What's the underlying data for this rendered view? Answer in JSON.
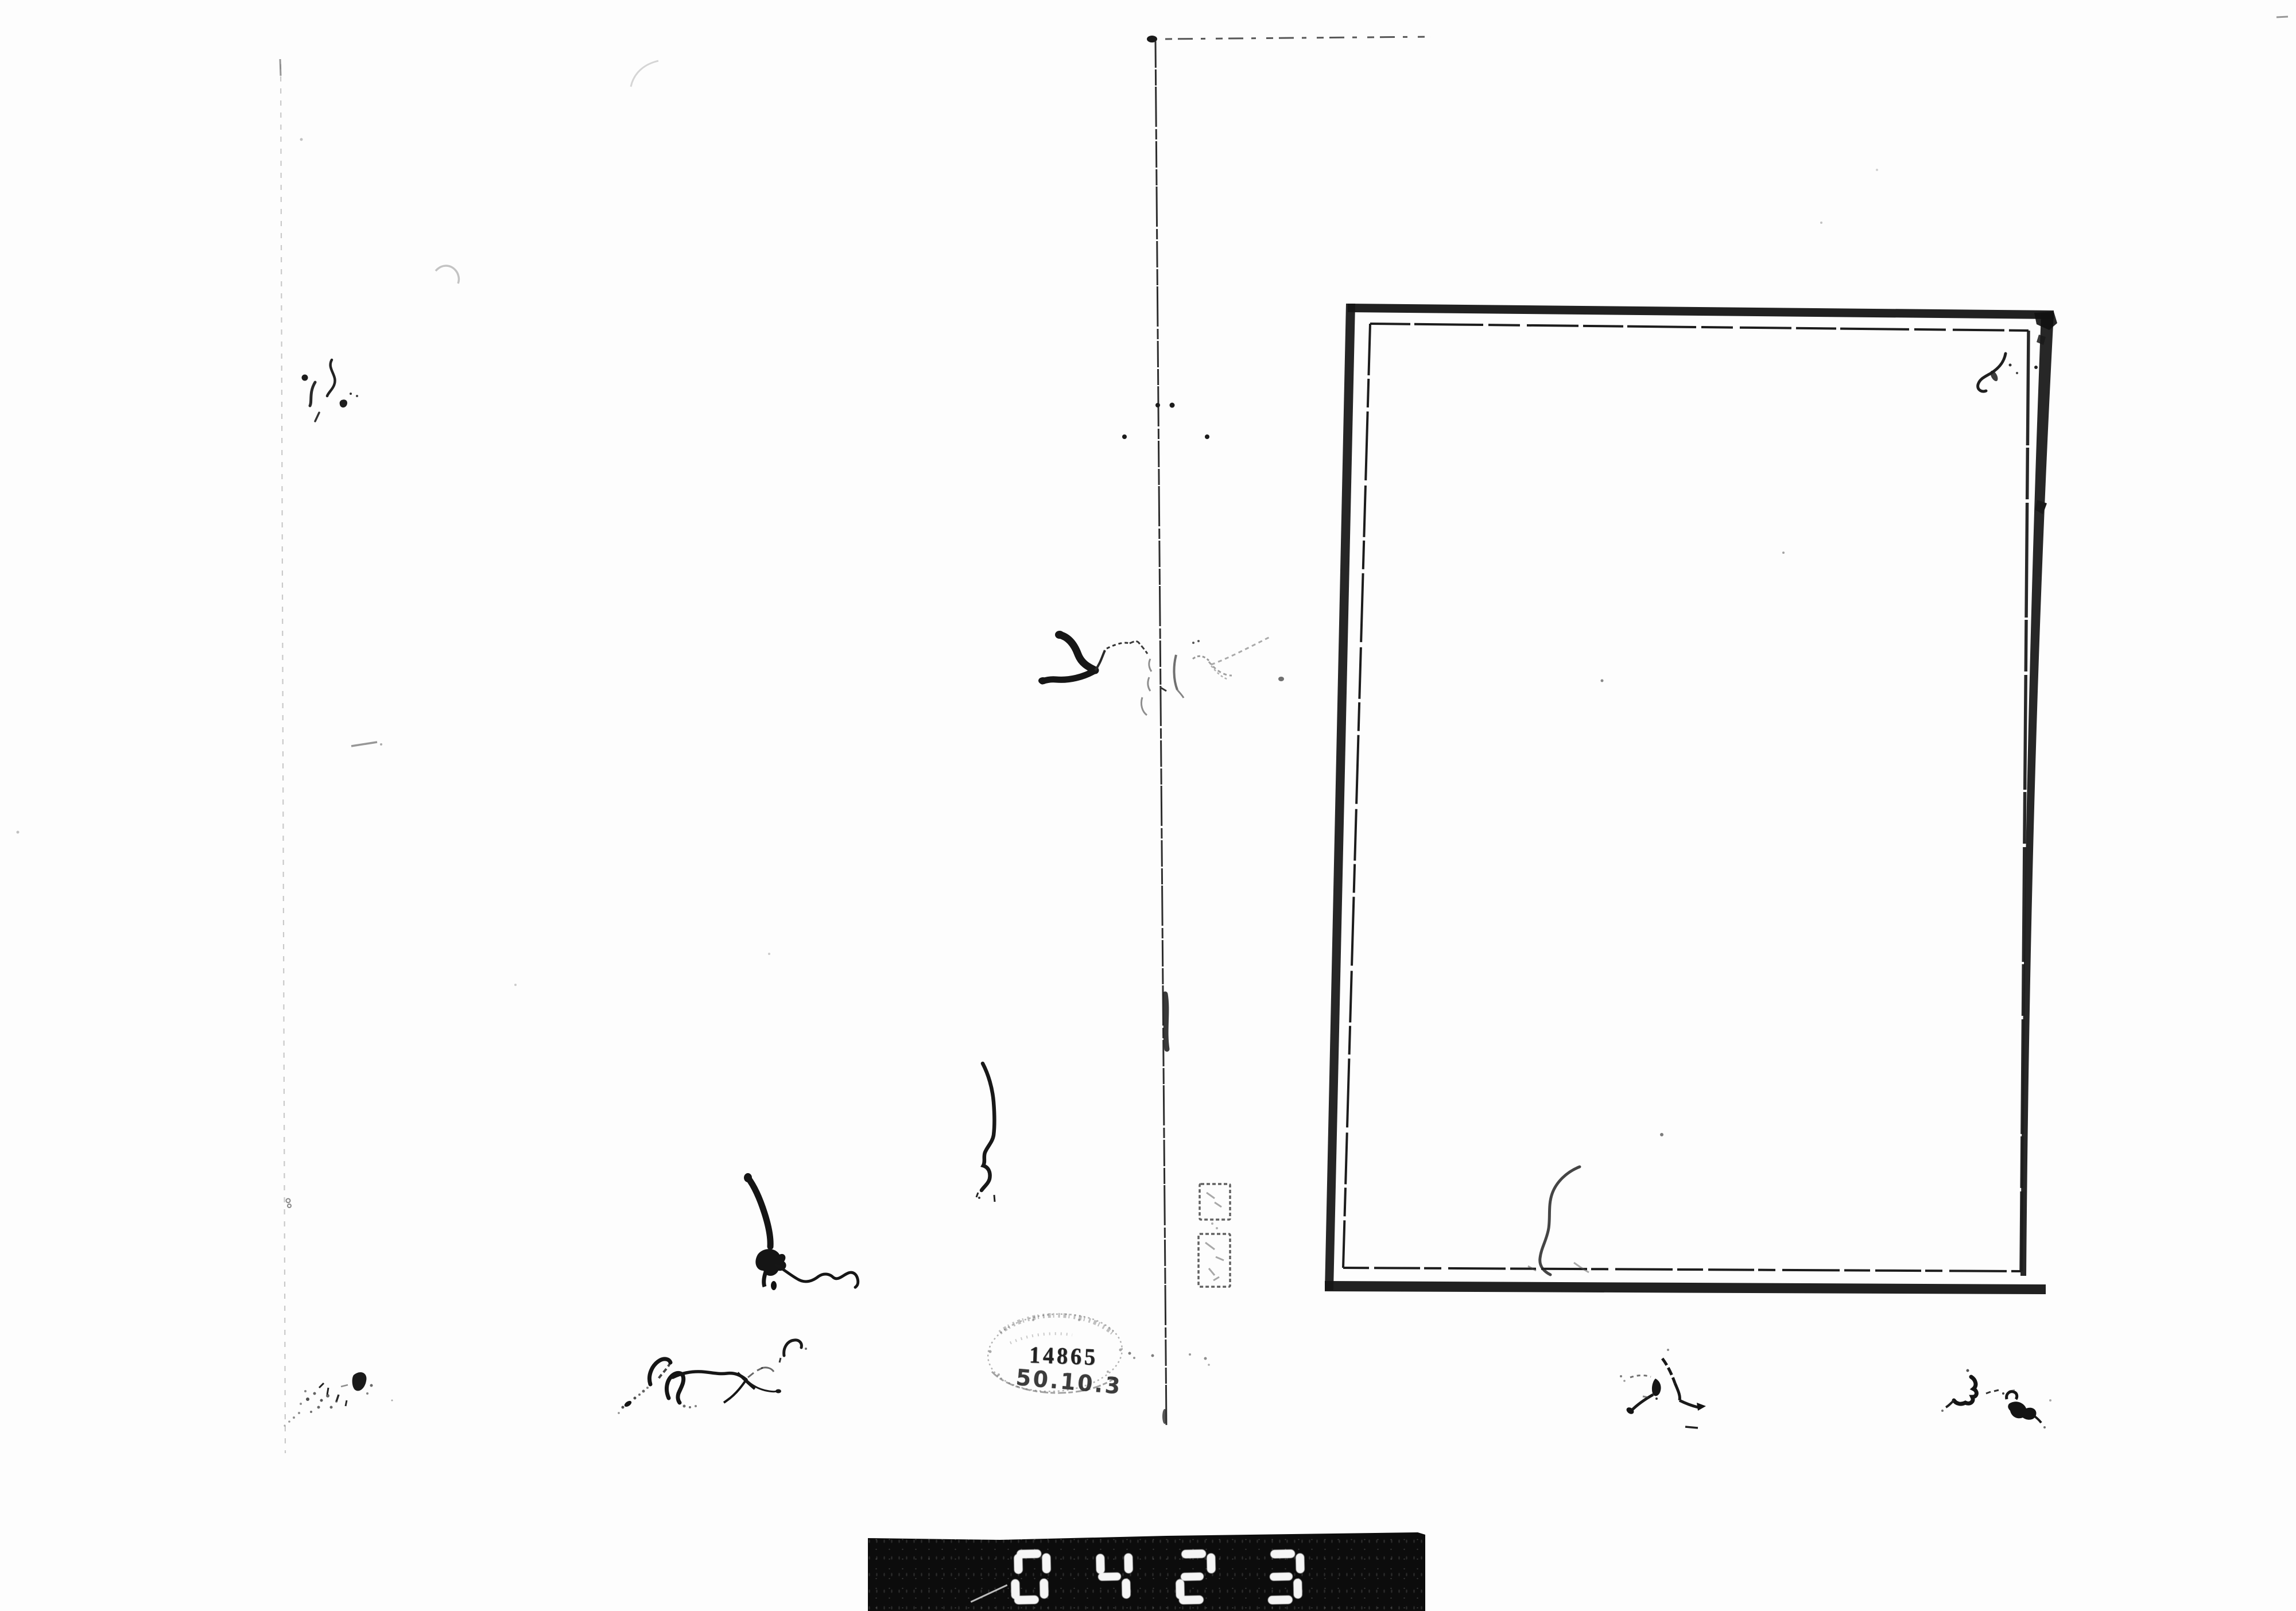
{
  "library_stamp": {
    "accession_number": "14865",
    "shelfmark": "50.10.3"
  },
  "frame_counter": {
    "value": "0423"
  },
  "colors": {
    "paper": "#fdfdfd",
    "ink": "#151515",
    "faint_ink": "#777777",
    "counter_bar": "#0c0c0c",
    "counter_digit": "#f5f5f5",
    "stamp_ink": "#222222"
  },
  "artifacts": [
    "page-fold-line",
    "page-top-edge-dashes",
    "left-page-edge-line",
    "book-frame-border",
    "frame-interior-marks",
    "ink-hair-marks",
    "foxing-specks",
    "collection-seal",
    "library-stamp-oval",
    "film-frame-counter"
  ]
}
